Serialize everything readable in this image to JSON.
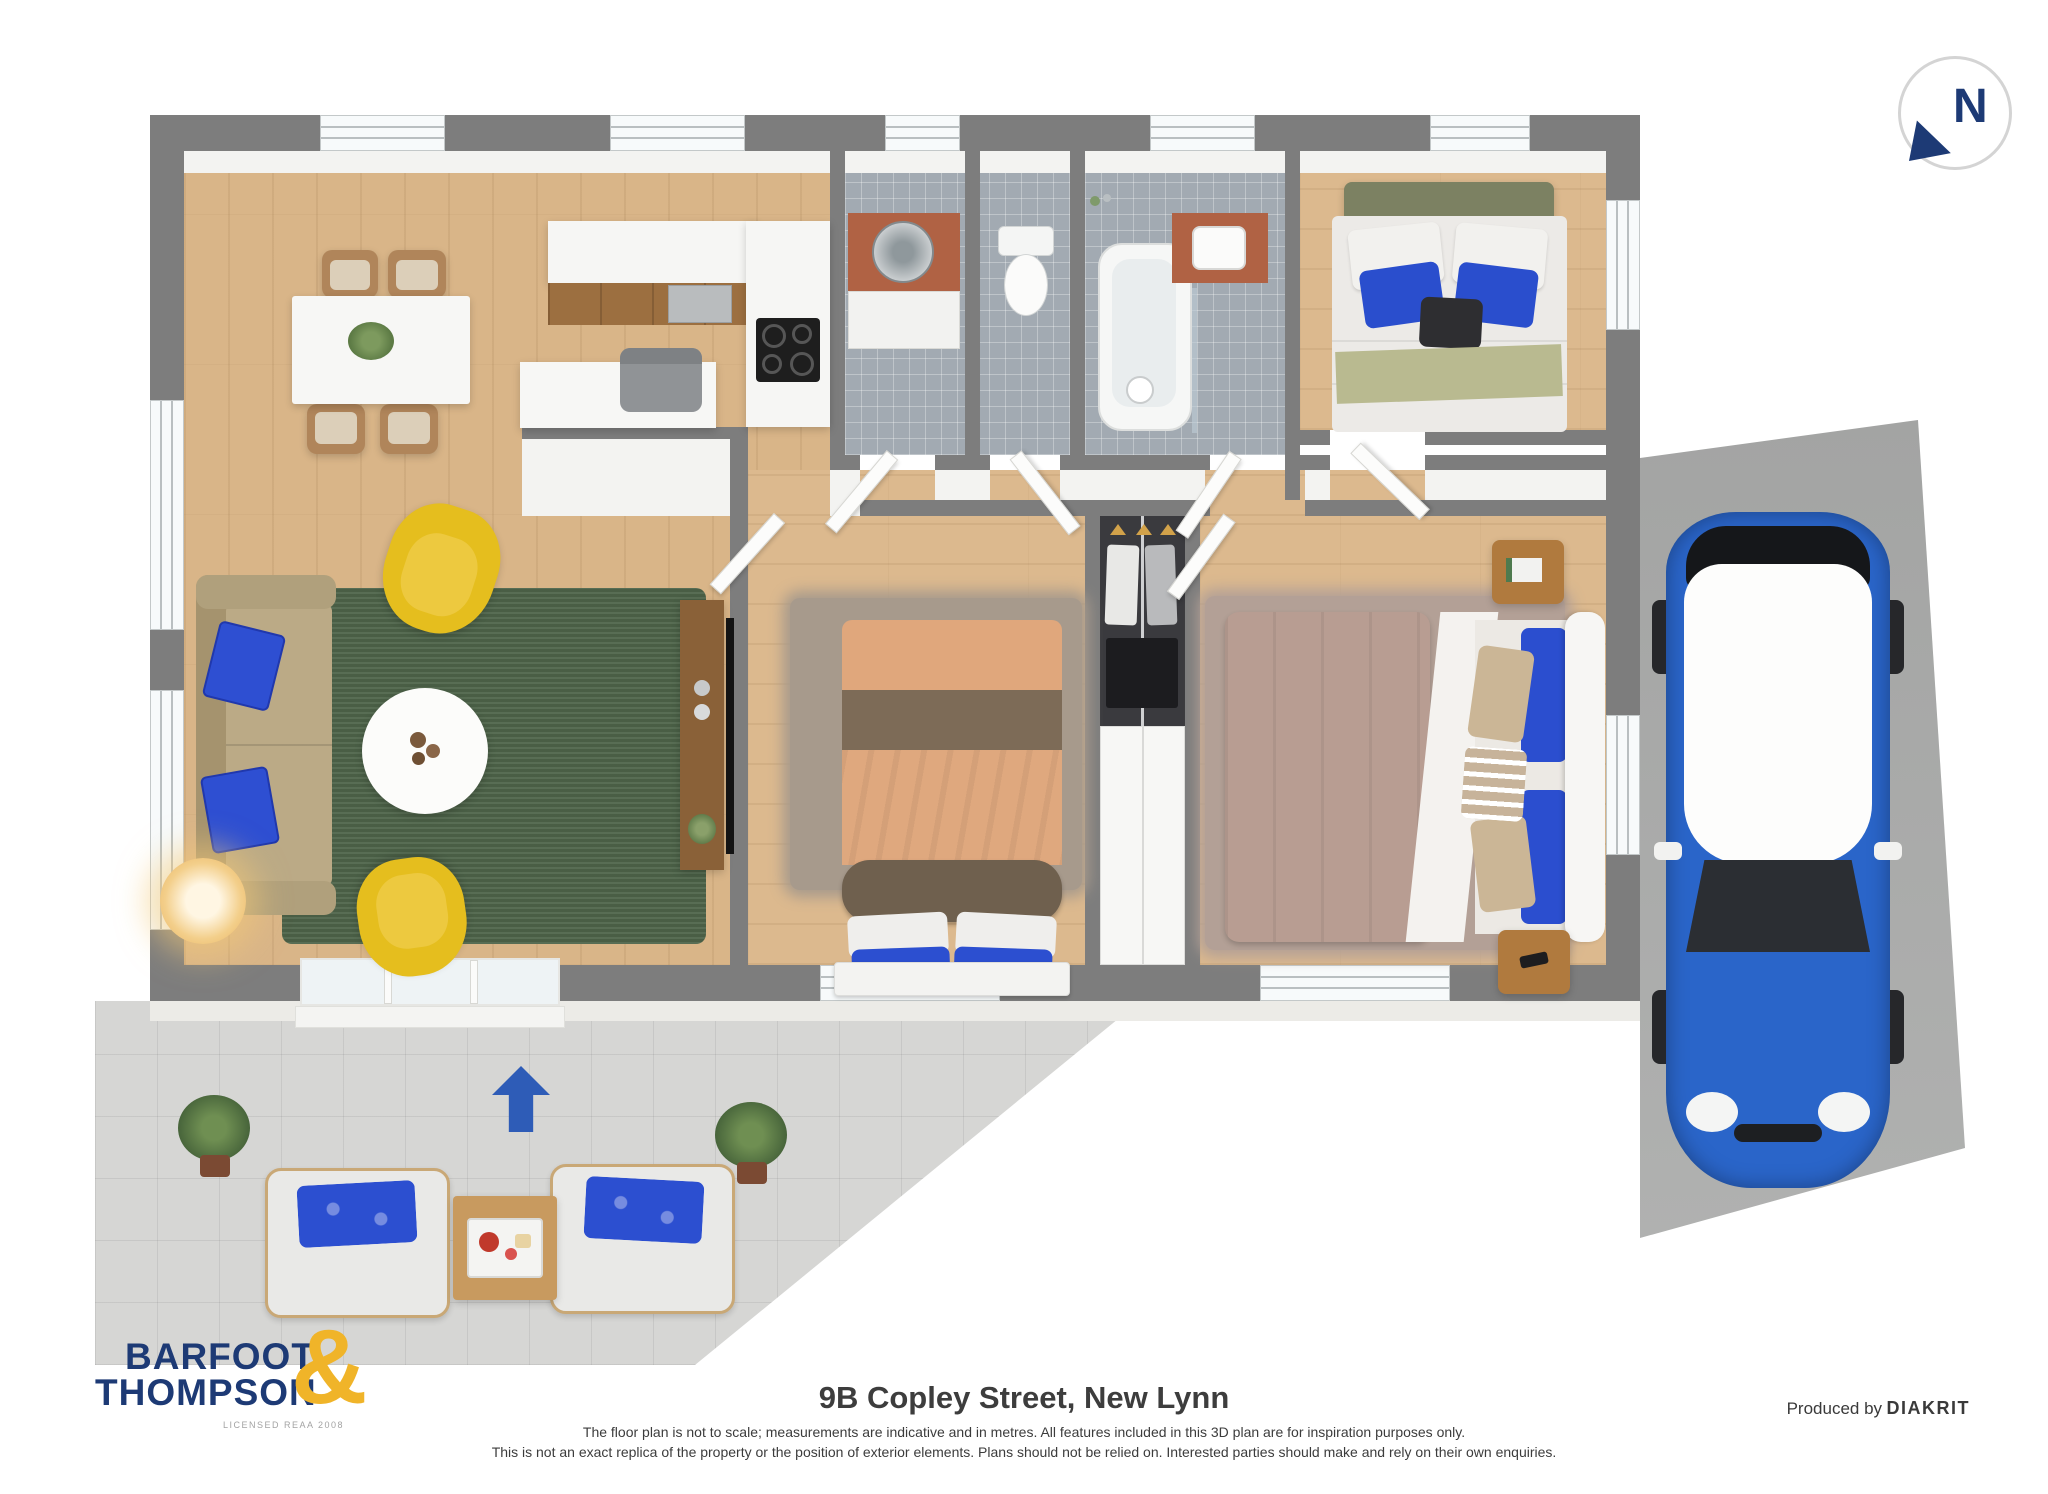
{
  "branding": {
    "logo_line1": "BARFOOT",
    "logo_line2": "THOMPSON",
    "ampersand": "&",
    "license": "LICENSED REAA 2008"
  },
  "compass": {
    "label": "N"
  },
  "footer": {
    "title": "9B Copley Street, New Lynn",
    "disclaimer_line1": "The floor plan is not to scale; measurements are indicative and in metres. All features included in this 3D plan are for inspiration purposes only.",
    "disclaimer_line2": "This is not an exact replica of the property or the position of exterior elements. Plans should not be relied on. Interested parties should make and rely on their own enquiries.",
    "produced_by": "Produced by",
    "producer": "DIAKRIT"
  },
  "icons": {
    "north_arrow": "north-arrow-icon",
    "entrance_arrow": "entrance-arrow-icon"
  },
  "colors": {
    "brand_navy": "#1d3a75",
    "brand_gold": "#f0b429",
    "arrow_blue": "#2e5cb7",
    "wall_gray": "#7d7d7d",
    "wood_floor": "#d9b588",
    "tile_gray": "#a2aab2",
    "rug_green": "#4e6449",
    "car_blue": "#2a65c9",
    "pillow_blue": "#2c4fd0",
    "patio_gray": "#d6d6d4",
    "driveway_gray": "#a8a9a8"
  }
}
